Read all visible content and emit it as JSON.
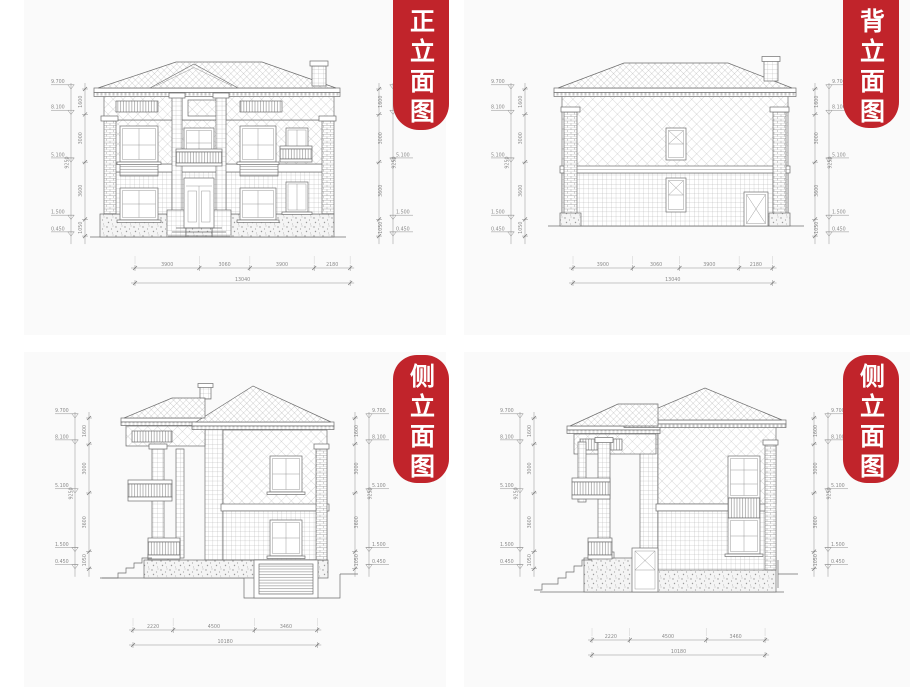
{
  "sheet": {
    "background": "#ffffff",
    "panel_background": "#fafafa"
  },
  "badge": {
    "color": "#c1242b",
    "text_color": "#ffffff"
  },
  "dims_vertical": {
    "levels": [
      "9.700",
      "8.100",
      "5.100",
      "1.500",
      "0.450"
    ],
    "segments": [
      "1600",
      "3000",
      "3600",
      "1050"
    ],
    "total": "9250"
  },
  "panels": [
    {
      "id": "front-elevation",
      "title": "正立面图",
      "bottom_segments": [
        "3900",
        "3060",
        "3900",
        "2180"
      ],
      "bottom_total": "13040"
    },
    {
      "id": "back-elevation",
      "title": "背立面图",
      "bottom_segments": [
        "3900",
        "3060",
        "3900",
        "2180"
      ],
      "bottom_total": "13040"
    },
    {
      "id": "side-elevation-a",
      "title": "侧立面图",
      "bottom_segments": [
        "2220",
        "4500",
        "3460"
      ],
      "bottom_total": "10180"
    },
    {
      "id": "side-elevation-b",
      "title": "侧立面图",
      "bottom_segments": [
        "2220",
        "4500",
        "3460"
      ],
      "bottom_total": "10180"
    }
  ]
}
